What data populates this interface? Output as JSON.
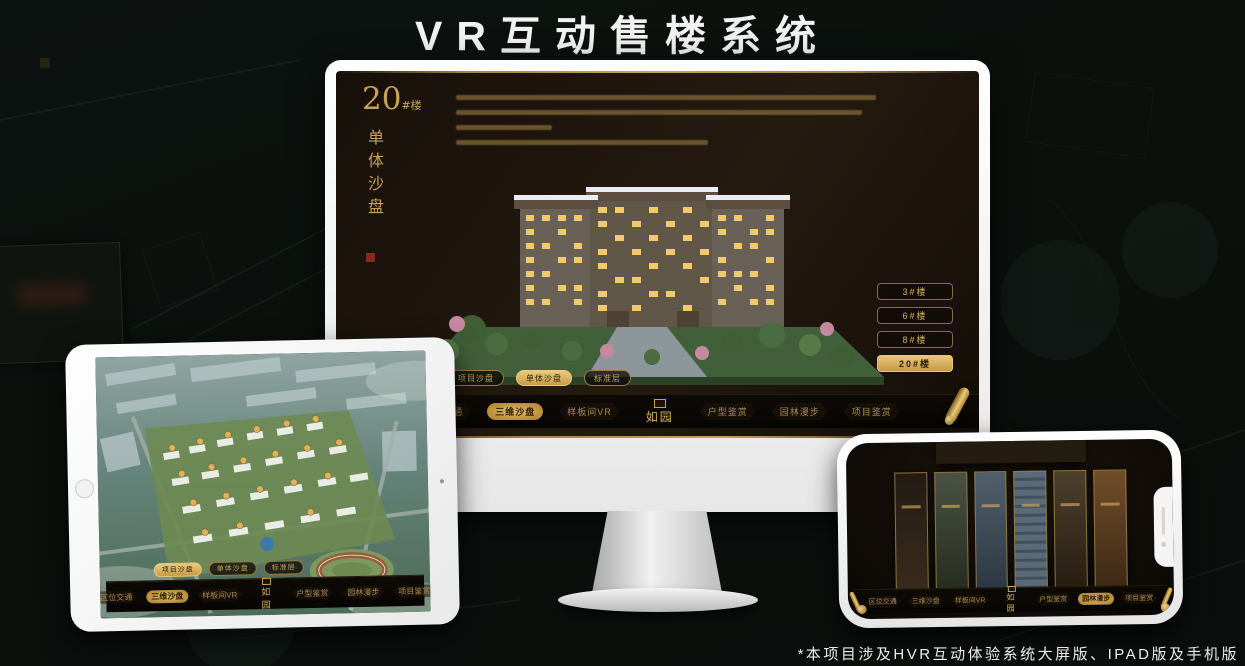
{
  "page": {
    "title": "VR互动售楼系统",
    "footnote": "*本项目涉及HVR互动体验系统大屏版、IPAD版及手机版"
  },
  "colors": {
    "background": "#0b100d",
    "gold": "#c9a158",
    "gold_selected": "#e9c677",
    "screen_background": "#1c140c",
    "menu_background": "#0a0704",
    "device_white": "#f4f4f4"
  },
  "desktop_app": {
    "heading": {
      "number": "20",
      "suffix": "#楼",
      "vertical_title": "单体沙盘"
    },
    "floor_buttons": [
      {
        "label": "3#楼",
        "selected": false
      },
      {
        "label": "6#楼",
        "selected": false
      },
      {
        "label": "8#楼",
        "selected": false
      },
      {
        "label": "20#楼",
        "selected": true
      }
    ],
    "sub_tabs": [
      {
        "label": "项目沙盘",
        "selected": false
      },
      {
        "label": "单体沙盘",
        "selected": true
      },
      {
        "label": "标准层",
        "selected": false
      }
    ],
    "menu": {
      "logo": "如园",
      "items_left": [
        {
          "label": "区位交通",
          "selected": false
        },
        {
          "label": "三维沙盘",
          "selected": true
        },
        {
          "label": "样板间VR",
          "selected": false
        }
      ],
      "items_right": [
        {
          "label": "户型鉴赏",
          "selected": false
        },
        {
          "label": "园林漫步",
          "selected": false
        },
        {
          "label": "项目鉴赏",
          "selected": false
        }
      ]
    }
  },
  "ipad_app": {
    "sub_tabs": [
      {
        "label": "项目沙盘",
        "selected": true
      },
      {
        "label": "单体沙盘",
        "selected": false
      },
      {
        "label": "标准层",
        "selected": false
      }
    ],
    "menu": {
      "logo": "如园",
      "items_left": [
        {
          "label": "区位交通",
          "selected": false
        },
        {
          "label": "三维沙盘",
          "selected": true
        },
        {
          "label": "样板间VR",
          "selected": false
        }
      ],
      "items_right": [
        {
          "label": "户型鉴赏",
          "selected": false
        },
        {
          "label": "园林漫步",
          "selected": false
        },
        {
          "label": "项目鉴赏",
          "selected": false
        }
      ]
    }
  },
  "phone_app": {
    "menu": {
      "logo": "如园",
      "items_left": [
        {
          "label": "区位交通",
          "selected": false
        },
        {
          "label": "三维沙盘",
          "selected": false
        },
        {
          "label": "样板间VR",
          "selected": false
        }
      ],
      "items_right": [
        {
          "label": "户型鉴赏",
          "selected": false
        },
        {
          "label": "园林漫步",
          "selected": true
        },
        {
          "label": "项目鉴赏",
          "selected": false
        }
      ]
    }
  }
}
